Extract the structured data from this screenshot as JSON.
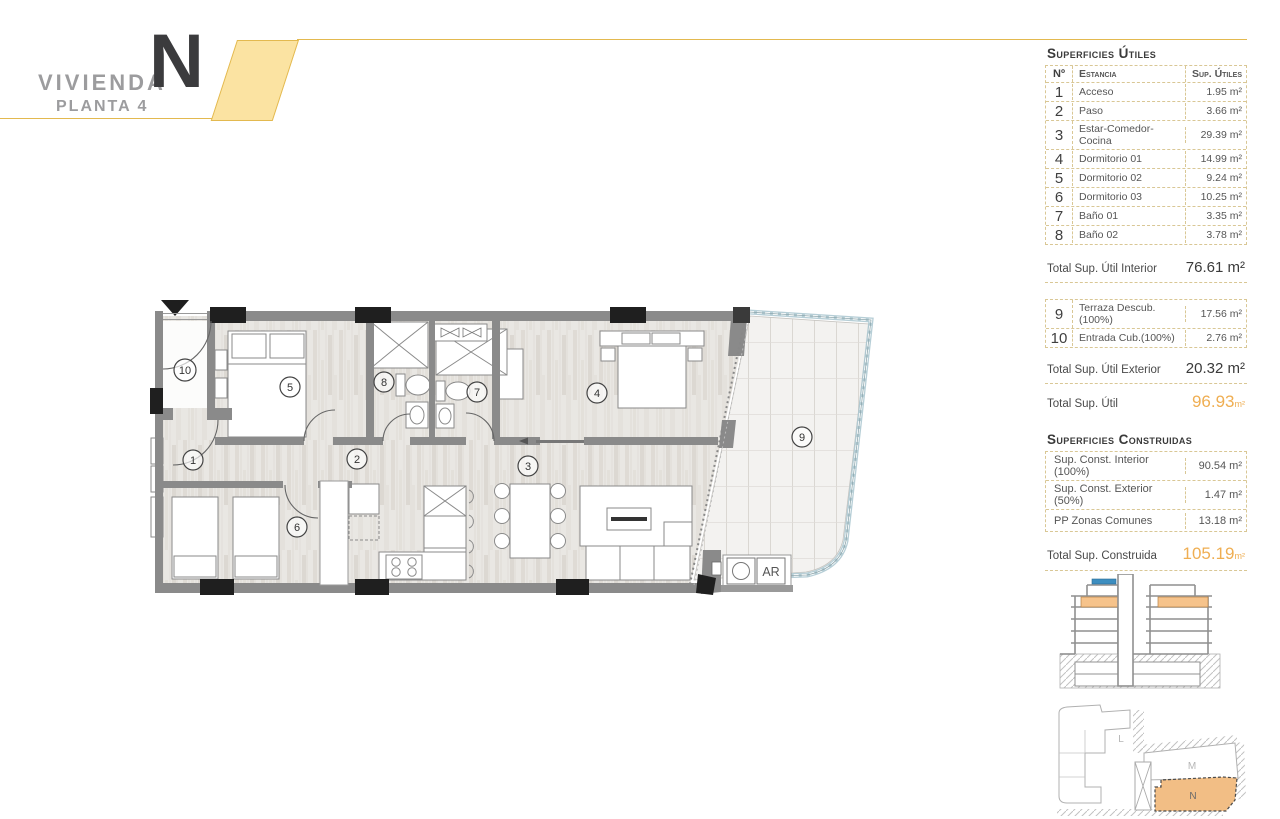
{
  "header": {
    "title": "VIVIENDA",
    "big_letter": "N",
    "floor": "PLANTA 4"
  },
  "tables": {
    "utiles": {
      "heading": "Superficies Útiles",
      "columns": {
        "num": "Nº",
        "name": "Estancia",
        "area": "Sup. Útiles"
      },
      "rows": [
        {
          "num": "1",
          "name": "Acceso",
          "area": "1.95 m²"
        },
        {
          "num": "2",
          "name": "Paso",
          "area": "3.66 m²"
        },
        {
          "num": "3",
          "name": "Estar-Comedor-Cocina",
          "area": "29.39 m²"
        },
        {
          "num": "4",
          "name": "Dormitorio 01",
          "area": "14.99 m²"
        },
        {
          "num": "5",
          "name": "Dormitorio 02",
          "area": "9.24 m²"
        },
        {
          "num": "6",
          "name": "Dormitorio 03",
          "area": "10.25 m²"
        },
        {
          "num": "7",
          "name": "Baño 01",
          "area": "3.35 m²"
        },
        {
          "num": "8",
          "name": "Baño 02",
          "area": "3.78 m²"
        }
      ],
      "total_interior": {
        "label": "Total Sup. Útil Interior",
        "value": "76.61 m²"
      },
      "exterior_rows": [
        {
          "num": "9",
          "name": "Terraza Descub.(100%)",
          "area": "17.56 m²"
        },
        {
          "num": "10",
          "name": "Entrada Cub.(100%)",
          "area": "2.76 m²"
        }
      ],
      "total_exterior": {
        "label": "Total Sup. Útil Exterior",
        "value": "20.32 m²"
      },
      "total": {
        "label": "Total Sup. Útil",
        "value": "96.93",
        "unit": "m²"
      }
    },
    "construidas": {
      "heading": "Superficies Construidas",
      "rows": [
        {
          "name": "Sup. Const. Interior (100%)",
          "area": "90.54 m²"
        },
        {
          "name": "Sup. Const. Exterior (50%)",
          "area": "1.47 m²"
        },
        {
          "name": "PP Zonas Comunes",
          "area": "13.18 m²"
        }
      ],
      "total": {
        "label": "Total Sup. Construida",
        "value": "105.19",
        "unit": "m²"
      }
    }
  },
  "plan": {
    "room_numbers": [
      "1",
      "2",
      "3",
      "4",
      "5",
      "6",
      "7",
      "8",
      "9",
      "10"
    ],
    "ar_label": "AR"
  },
  "site_plan": {
    "labels": {
      "l": "L",
      "m": "M",
      "n": "N"
    }
  },
  "colors": {
    "accent_gold": "#e3b94f",
    "accent_fill": "#fbe3a2",
    "total_orange": "#efae52",
    "highlight_orange": "#f6c38b",
    "roof_blue": "#3d8ec0"
  }
}
